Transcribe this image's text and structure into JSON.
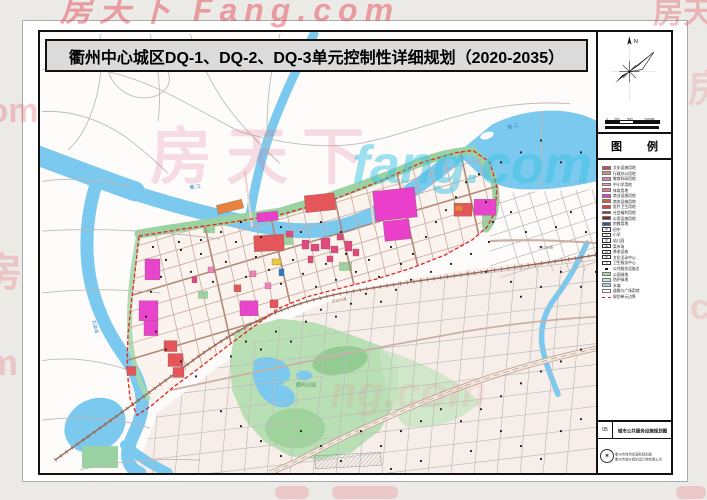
{
  "title": "衢州中心城区DQ-1、DQ-2、DQ-3单元控制性详细规划（2020-2035）",
  "watermarks": {
    "top": "房天下 Fang.com",
    "top_right": "房天",
    "map_cn": "房天下",
    "map_en": "fang.com",
    "mid": "ng.com",
    "left_a": ".om",
    "left_b": "房",
    "left_c": "m",
    "right_a": "房",
    "right_b": "c"
  },
  "sidebar": {
    "compass_n": "N",
    "scalebar": {
      "ticks": [
        "0",
        "200",
        "500",
        "1000M"
      ]
    },
    "legend_title": "图 例",
    "legend": {
      "items": [
        {
          "type": "fill",
          "color": "#D04858",
          "label": "文化设施用地"
        },
        {
          "type": "fill",
          "color": "#C89878",
          "label": "行政办公用地"
        },
        {
          "type": "fill",
          "color": "#D884B8",
          "label": "教育科研用地"
        },
        {
          "type": "fill",
          "color": "#F0A0C0",
          "label": "中小学用地"
        },
        {
          "type": "fill",
          "color": "#E87888",
          "label": "体育用地"
        },
        {
          "type": "fill",
          "color": "#EE3FD0",
          "label": "商业设施用地"
        },
        {
          "type": "fill",
          "color": "#D06830",
          "label": "商务设施用地"
        },
        {
          "type": "fill",
          "color": "#E04040",
          "label": "医疗卫生用地"
        },
        {
          "type": "fill",
          "color": "#A83030",
          "label": "社会福利用地"
        },
        {
          "type": "fill",
          "color": "#882424",
          "label": "公用设施用地"
        },
        {
          "type": "fill",
          "color": "#2858A8",
          "label": "宗教用地"
        },
        {
          "type": "sym",
          "glyph": "中",
          "label": "初中"
        },
        {
          "type": "sym",
          "glyph": "小",
          "label": "小学"
        },
        {
          "type": "sym",
          "glyph": "幼",
          "label": "幼儿园"
        },
        {
          "type": "sym",
          "glyph": "菜",
          "label": "菜市场"
        },
        {
          "type": "sym",
          "glyph": "养",
          "label": "养老设施"
        },
        {
          "type": "sym",
          "glyph": "文",
          "label": "文化活动中心"
        },
        {
          "type": "sym",
          "glyph": "卫",
          "label": "卫生服务中心"
        },
        {
          "type": "dot",
          "label": "公共服务设施点"
        },
        {
          "type": "fill",
          "color": "#A8D8A8",
          "label": "公园绿地"
        },
        {
          "type": "fill",
          "color": "#C8E8C8",
          "label": "防护绿地"
        },
        {
          "type": "fill",
          "color": "#9FD7F2",
          "label": "水域"
        },
        {
          "type": "fill",
          "color": "#FFFFFF",
          "label": "道路与广场用地"
        },
        {
          "type": "dash",
          "label": "规划单元边界"
        }
      ]
    },
    "sheet": {
      "number": "05",
      "name": "城市公共服务设施规划图"
    },
    "stamp": {
      "line1": "衢州市自然资源和规划局",
      "line2": "衢州市城乡规划设计院有限公司"
    }
  },
  "map": {
    "labels": [
      {
        "text": "衢 江",
        "x": 150,
        "y": 158,
        "size": 5,
        "color": "#3A88C8",
        "rot": -8
      },
      {
        "text": "衢 江",
        "x": 468,
        "y": 98,
        "size": 5,
        "color": "#3A88C8",
        "rot": -16
      },
      {
        "text": "石梁溪",
        "x": 52,
        "y": 290,
        "size": 4.5,
        "color": "#3A88C8",
        "rot": 75
      },
      {
        "text": "鹿鸣公园",
        "x": 256,
        "y": 356,
        "size": 5,
        "color": "#4E9A5E",
        "rot": 0
      },
      {
        "text": "白云大道",
        "x": 292,
        "y": 272,
        "size": 3.8,
        "color": "#8A7A70",
        "rot": -10
      },
      {
        "text": "三江东路",
        "x": 498,
        "y": 218,
        "size": 3.8,
        "color": "#8A7A70",
        "rot": -2
      }
    ],
    "blocks": [
      [
        334,
        158,
        42,
        30,
        "#E93FCB",
        -6
      ],
      [
        344,
        189,
        26,
        20,
        "#E93FCB",
        -6
      ],
      [
        434,
        168,
        22,
        16,
        "#E845CC",
        0
      ],
      [
        414,
        172,
        18,
        13,
        "#E4565A",
        0
      ],
      [
        415,
        174,
        8,
        6,
        "#E8833C",
        0
      ],
      [
        214,
        204,
        30,
        16,
        "#E4565A",
        -3
      ],
      [
        265,
        163,
        30,
        17,
        "#E4565A",
        -6
      ],
      [
        177,
        171,
        26,
        9,
        "#E8833C",
        -14
      ],
      [
        217,
        181,
        21,
        9,
        "#E93FCB",
        -6
      ],
      [
        105,
        228,
        15,
        21,
        "#E845CC",
        0
      ],
      [
        99,
        270,
        19,
        20,
        "#E845CC",
        0
      ],
      [
        104,
        290,
        14,
        15,
        "#E845CC",
        0
      ],
      [
        200,
        270,
        18,
        15,
        "#E845CC",
        0
      ],
      [
        124,
        310,
        13,
        11,
        "#E4565A",
        0
      ],
      [
        128,
        323,
        15,
        13,
        "#E4565A",
        0
      ],
      [
        133,
        337,
        11,
        10,
        "#E4565A",
        0
      ],
      [
        87,
        336,
        9,
        9,
        "#E4565A",
        0
      ],
      [
        262,
        209,
        7,
        9,
        "#E0487E",
        0
      ],
      [
        271,
        213,
        8,
        7,
        "#E0487E",
        0
      ],
      [
        281,
        207,
        9,
        11,
        "#E0487E",
        0
      ],
      [
        291,
        215,
        7,
        7,
        "#E0487E",
        0
      ],
      [
        287,
        225,
        6,
        6,
        "#E0487E",
        0
      ],
      [
        268,
        225,
        5,
        7,
        "#E0487E",
        0
      ],
      [
        297,
        203,
        6,
        6,
        "#E0487E",
        0
      ],
      [
        305,
        210,
        7,
        10,
        "#E0487E",
        0
      ],
      [
        313,
        218,
        6,
        7,
        "#E0487E",
        0
      ],
      [
        232,
        228,
        9,
        6,
        "#E8C83C",
        0
      ],
      [
        239,
        238,
        5,
        7,
        "#2878C8",
        0
      ],
      [
        194,
        254,
        7,
        7,
        "#E4565A",
        0
      ],
      [
        230,
        269,
        8,
        8,
        "#E4565A",
        0
      ],
      [
        246,
        200,
        7,
        6,
        "#E0487E",
        0
      ],
      [
        210,
        240,
        6,
        6,
        "#F080B8",
        0
      ],
      [
        225,
        252,
        6,
        6,
        "#F080B8",
        0
      ],
      [
        168,
        236,
        6,
        6,
        "#F080B8",
        0
      ],
      [
        152,
        246,
        5,
        6,
        "#E0487E",
        0
      ]
    ],
    "facility_points": [
      [
        112,
        215
      ],
      [
        125,
        228
      ],
      [
        138,
        210
      ],
      [
        150,
        240
      ],
      [
        160,
        222
      ],
      [
        172,
        250
      ],
      [
        185,
        230
      ],
      [
        195,
        210
      ],
      [
        205,
        245
      ],
      [
        215,
        225
      ],
      [
        228,
        238
      ],
      [
        240,
        252
      ],
      [
        252,
        228
      ],
      [
        262,
        242
      ],
      [
        275,
        255
      ],
      [
        285,
        232
      ],
      [
        295,
        248
      ],
      [
        305,
        222
      ],
      [
        315,
        240
      ],
      [
        328,
        228
      ],
      [
        338,
        245
      ],
      [
        350,
        215
      ],
      [
        360,
        232
      ],
      [
        372,
        222
      ],
      [
        385,
        205
      ],
      [
        395,
        190
      ],
      [
        405,
        178
      ],
      [
        415,
        165
      ],
      [
        425,
        150
      ],
      [
        438,
        142
      ],
      [
        445,
        170
      ],
      [
        452,
        190
      ],
      [
        300,
        200
      ],
      [
        280,
        190
      ],
      [
        260,
        200
      ],
      [
        240,
        195
      ],
      [
        220,
        205
      ],
      [
        200,
        190
      ],
      [
        180,
        200
      ],
      [
        160,
        208
      ],
      [
        140,
        218
      ],
      [
        120,
        245
      ],
      [
        110,
        260
      ],
      [
        105,
        285
      ],
      [
        115,
        300
      ],
      [
        125,
        318
      ],
      [
        140,
        330
      ],
      [
        155,
        345
      ],
      [
        190,
        325
      ],
      [
        205,
        310
      ],
      [
        220,
        318
      ],
      [
        235,
        300
      ],
      [
        250,
        310
      ],
      [
        265,
        290
      ],
      [
        280,
        278
      ],
      [
        295,
        285
      ],
      [
        310,
        272
      ],
      [
        325,
        262
      ],
      [
        340,
        270
      ],
      [
        355,
        258
      ],
      [
        370,
        248
      ],
      [
        390,
        240
      ],
      [
        410,
        232
      ],
      [
        430,
        222
      ],
      [
        448,
        210
      ],
      [
        180,
        380
      ],
      [
        200,
        395
      ],
      [
        220,
        410
      ],
      [
        240,
        425
      ],
      [
        260,
        400
      ],
      [
        280,
        415
      ],
      [
        300,
        430
      ],
      [
        320,
        400
      ],
      [
        340,
        415
      ],
      [
        360,
        400
      ],
      [
        380,
        390
      ],
      [
        400,
        378
      ],
      [
        420,
        390
      ],
      [
        440,
        378
      ],
      [
        460,
        365
      ],
      [
        480,
        352
      ],
      [
        500,
        340
      ],
      [
        520,
        330
      ],
      [
        540,
        318
      ],
      [
        460,
        400
      ],
      [
        480,
        415
      ],
      [
        500,
        428
      ],
      [
        520,
        400
      ],
      [
        540,
        388
      ],
      [
        430,
        420
      ],
      [
        380,
        430
      ],
      [
        350,
        438
      ],
      [
        470,
        180
      ],
      [
        485,
        200
      ],
      [
        500,
        215
      ],
      [
        515,
        195
      ],
      [
        530,
        180
      ],
      [
        545,
        200
      ],
      [
        520,
        240
      ],
      [
        500,
        255
      ],
      [
        480,
        265
      ],
      [
        540,
        255
      ],
      [
        555,
        240
      ],
      [
        460,
        130
      ],
      [
        480,
        120
      ],
      [
        500,
        108
      ],
      [
        520,
        130
      ],
      [
        540,
        120
      ],
      [
        470,
        250
      ],
      [
        445,
        240
      ]
    ]
  }
}
